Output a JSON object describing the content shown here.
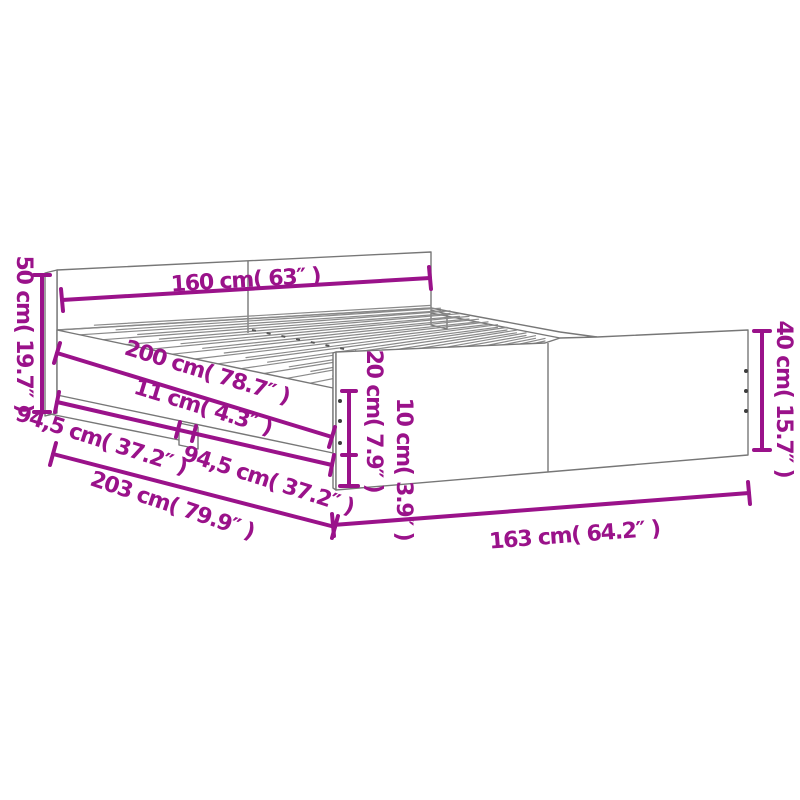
{
  "diagram": {
    "title": "bed-frame-dimension-diagram",
    "style": "isometric line drawing with magenta dimension callouts",
    "colors": {
      "dimension_accent": "#9A128A",
      "drawing_lines": "#777777",
      "background": "#FFFFFF"
    },
    "dimensions": {
      "headboard_width": "160 cm( 63″ )",
      "headboard_height": "50 cm( 19.7″ )",
      "slat_length": "200 cm( 78.7″ )",
      "center_leg_width": "11 cm( 4.3″ )",
      "left_span": "94,5 cm( 37.2″ )",
      "right_span": "94,5 cm( 37.2″ )",
      "total_length": "203 cm( 79.9″ )",
      "footboard_width": "163 cm( 64.2″ )",
      "footboard_height": "40 cm( 15.7″ )",
      "side_rail_height": "20 cm( 7.9″ )",
      "floor_clearance": "10 cm( 3.9″ )"
    }
  }
}
